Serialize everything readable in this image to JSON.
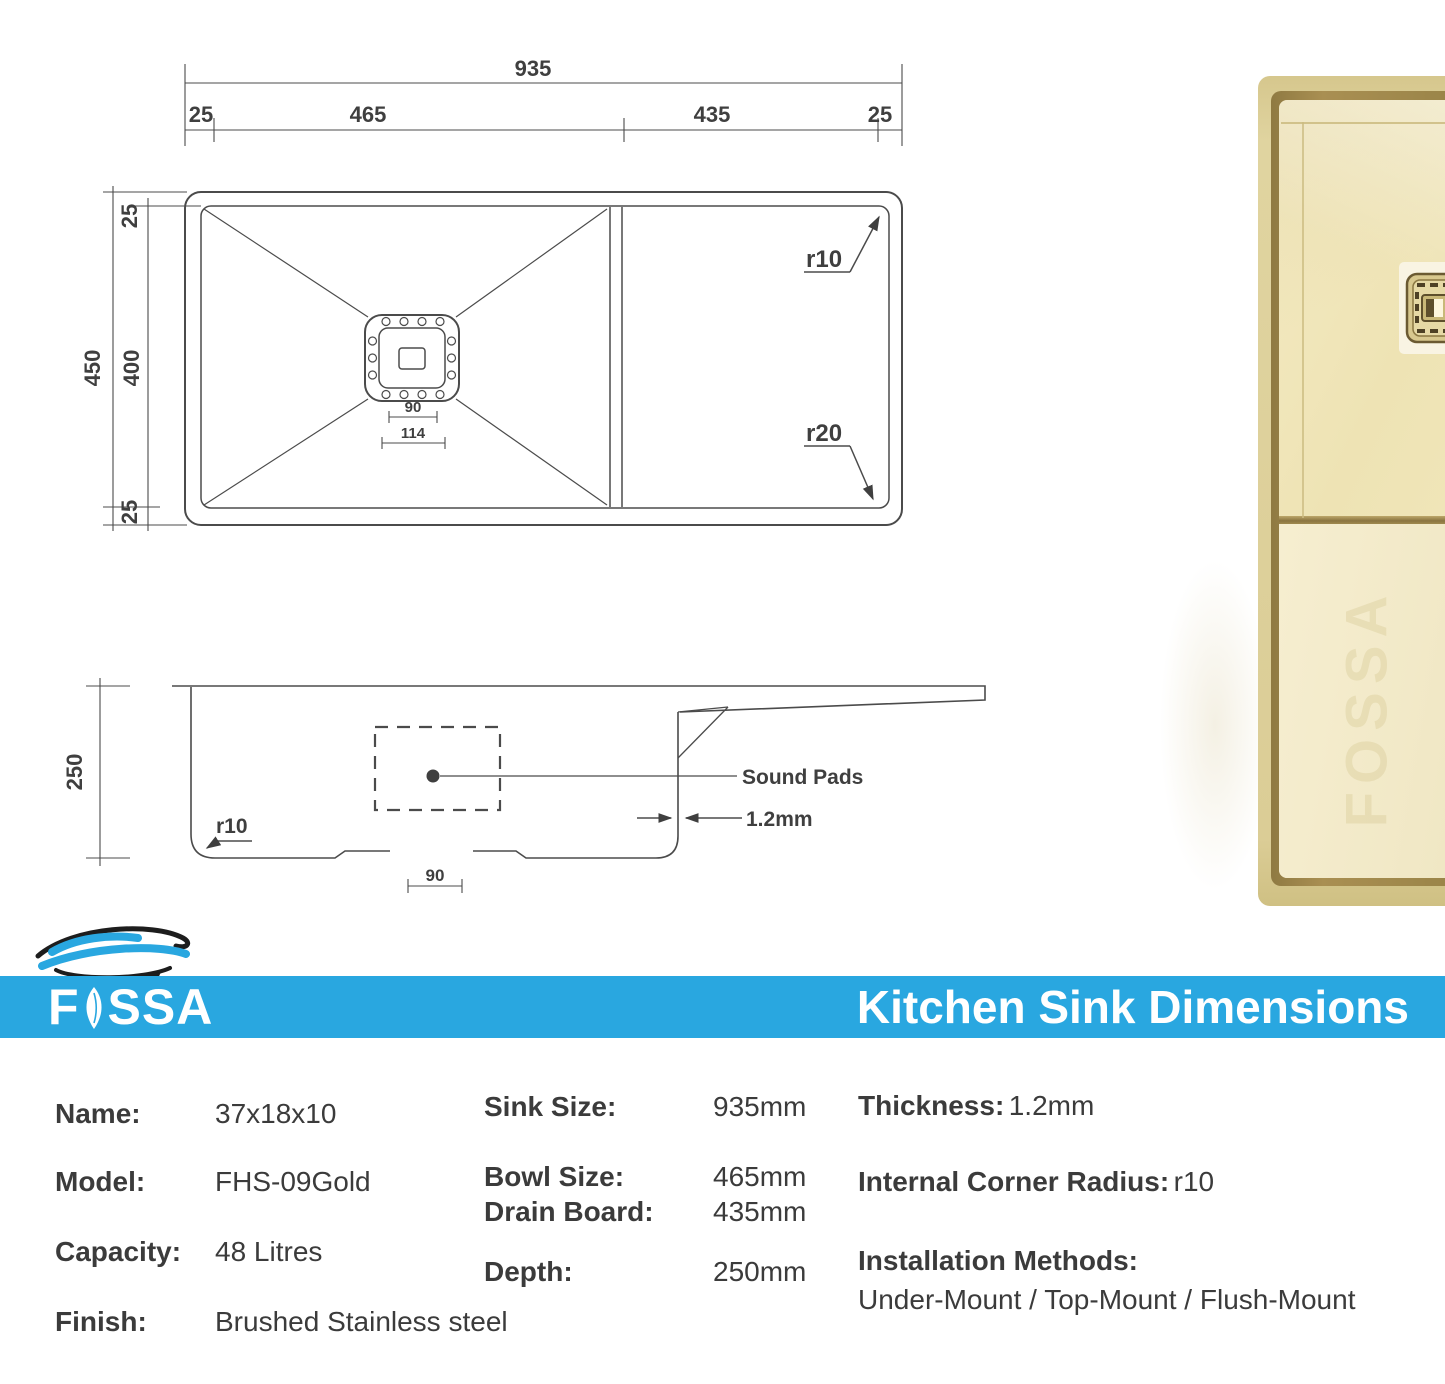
{
  "colors": {
    "banner_blue": "#29a7e0",
    "line_gray": "#4b4b4b",
    "text_gray": "#3b3b3b",
    "gold_frame": "#dbcd96",
    "gold_surface": "#f1e7bd",
    "gold_groove": "#9b8549"
  },
  "top_view": {
    "overall_width": "935",
    "left_margin": "25",
    "bowl_width": "465",
    "drainboard_width": "435",
    "right_margin": "25",
    "overall_depth": "450",
    "bowl_depth": "400",
    "top_margin": "25",
    "bottom_margin": "25",
    "drain_dim_inner": "90",
    "drain_dim_outer": "114",
    "corner_radius_top": "r10",
    "corner_radius_bottom": "r20"
  },
  "side_view": {
    "depth": "250",
    "bottom_radius": "r10",
    "drain_width": "90",
    "thickness": "1.2mm",
    "sound_pads_label": "Sound Pads"
  },
  "banner": {
    "brand_f": "F",
    "brand_ssa": "SSA",
    "brand_full": "FOSSA",
    "title": "Kitchen Sink Dimensions"
  },
  "photo": {
    "watermark": "FOSSA"
  },
  "specs": {
    "left": [
      {
        "label": "Name:",
        "value": "37x18x10"
      },
      {
        "label": "Model:",
        "value": "FHS-09Gold"
      },
      {
        "label": "Capacity:",
        "value": "48 Litres"
      },
      {
        "label": "Finish:",
        "value": "Brushed Stainless steel"
      }
    ],
    "middle": [
      {
        "label": "Sink Size:",
        "value": "935mm"
      },
      {
        "label": "Bowl Size:",
        "value": "465mm"
      },
      {
        "label": "Drain Board:",
        "value": "435mm"
      },
      {
        "label": "Depth:",
        "value": "250mm"
      }
    ],
    "right": {
      "thickness_label": "Thickness:",
      "thickness_value": "1.2mm",
      "icr_label": "Internal Corner Radius:",
      "icr_value": "r10",
      "install_label": "Installation Methods:",
      "install_value": "Under-Mount / Top-Mount / Flush-Mount"
    }
  }
}
